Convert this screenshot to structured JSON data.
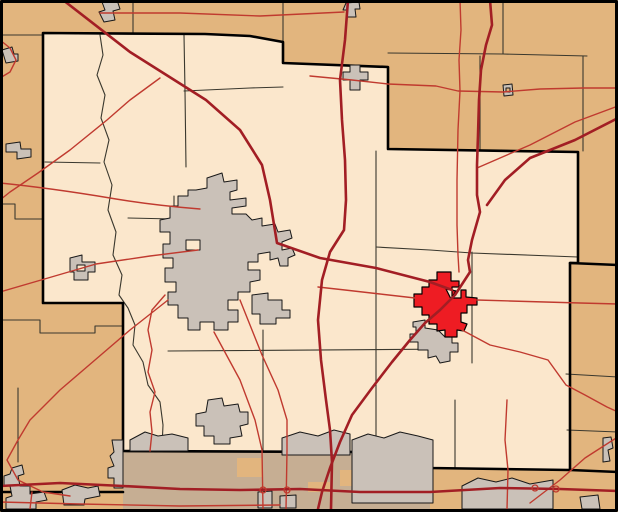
{
  "map": {
    "title": "county-municipality-locator-map",
    "canvas": {
      "width": 618,
      "height": 512
    },
    "colors": {
      "adjacent_county": "#e2b57e",
      "focal_county": "#fbe7cc",
      "municipality_gray": "#cac1b8",
      "urbanized_overlay": "#c6ae93",
      "highlight_red": "#ee1c23",
      "road_major": "#a21e24",
      "road_minor": "#c03a2f",
      "boundary_county": "#000000",
      "boundary_township": "#3a382e",
      "outline_municipality": "#181818",
      "frame": "#000000"
    },
    "layers": [
      {
        "name": "base",
        "kind": "rect",
        "items": [
          {
            "id": "surrounding-counties-fill",
            "x": 0,
            "y": 0,
            "w": 618,
            "h": 512,
            "fill": "adjacent_county"
          }
        ]
      },
      {
        "name": "county-fills",
        "kind": "path",
        "items": [
          {
            "id": "focal-county-fill",
            "fill": "focal_county",
            "d": "M43,33 L205,34 L250,36 L283,42 L283,63 L388,67 L388,149 L578,152 L578,263 L570,263 L570,470 L430,468 L430,454 L360,452 L123,451 L123,303 L43,303 Z"
          }
        ]
      },
      {
        "name": "urbanized-areas",
        "kind": "path",
        "items": [
          {
            "id": "urbanized-strip-south",
            "fill": "urbanized_overlay",
            "d": "M123,451 L360,452 L364,467 L430,468 L430,509 L123,509 Z"
          },
          {
            "id": "strip-tan-pocket-1",
            "fill": "adjacent_county",
            "d": "M237,458 L262,458 L262,477 L237,477 Z"
          },
          {
            "id": "strip-tan-pocket-2",
            "fill": "adjacent_county",
            "d": "M340,470 L362,470 L362,486 L340,486 Z"
          },
          {
            "id": "strip-tan-pocket-3",
            "fill": "adjacent_county",
            "d": "M308,482 L330,482 L330,492 L308,492 Z"
          }
        ]
      },
      {
        "name": "township-lines",
        "kind": "path",
        "stroke": "boundary_township",
        "width": 1.1,
        "items": [
          {
            "id": "township-line-1",
            "d": "M0,35 L43,35"
          },
          {
            "id": "township-line-2",
            "d": "M0,204 L15,204 L15,219 L43,219"
          },
          {
            "id": "township-line-3",
            "d": "M0,320 L40,320 L40,333 L95,333 L95,326 L123,326"
          },
          {
            "id": "township-line-4",
            "d": "M18,388 L18,462"
          },
          {
            "id": "township-line-5",
            "d": "M133,0 L133,33"
          },
          {
            "id": "township-line-6",
            "d": "M283,0 L283,42"
          },
          {
            "id": "township-line-7",
            "d": "M388,53 L503,54 L587,56"
          },
          {
            "id": "township-line-8",
            "d": "M503,0 L503,54"
          },
          {
            "id": "township-line-9",
            "d": "M480,56 L480,150"
          },
          {
            "id": "township-line-10",
            "d": "M583,56 L583,151"
          },
          {
            "id": "township-line-11",
            "d": "M566,374 L618,377"
          },
          {
            "id": "township-line-12",
            "d": "M567,430 L618,432"
          },
          {
            "id": "stream-line",
            "d": "M100,35 L103,55 L97,75 L105,95 L101,118 L109,140 L104,162 L112,185 L108,210 L116,232 L113,255 L122,275 L119,295 L128,308 L135,325 L133,345 L143,362 L148,385 L160,402 L163,425 L162,447"
          },
          {
            "id": "township-line-13",
            "d": "M45,162 L100,163"
          },
          {
            "id": "township-line-14",
            "d": "M128,218 L174,219"
          },
          {
            "id": "township-line-15",
            "d": "M174,196 L174,219"
          },
          {
            "id": "township-line-16",
            "d": "M184,35 L185,91 L186,167"
          },
          {
            "id": "township-line-17",
            "d": "M184,91 L250,88 L283,87"
          },
          {
            "id": "township-line-18",
            "d": "M168,351 L456,349"
          },
          {
            "id": "township-line-19",
            "d": "M263,330 L263,452"
          },
          {
            "id": "township-line-20",
            "d": "M376,151 L376,452"
          },
          {
            "id": "township-line-21",
            "d": "M455,400 L455,468"
          },
          {
            "id": "township-line-22",
            "d": "M472,252 L472,363"
          },
          {
            "id": "township-line-23",
            "d": "M376,247 L430,250 L472,253 L578,257"
          }
        ]
      },
      {
        "name": "county-boundaries",
        "kind": "path",
        "stroke": "boundary_county",
        "width": 2.6,
        "items": [
          {
            "id": "focal-county-boundary",
            "d": "M43,33 L205,34 L250,36 L283,42 L283,63 L388,67 L388,149 L578,152 L578,263 L570,263 L570,470 L430,468 L430,454 L360,452 L123,451 L123,303 L43,303 Z"
          },
          {
            "id": "county-boundary-southwest",
            "d": "M0,492 L123,492"
          },
          {
            "id": "county-boundary-southeast",
            "d": "M570,470 L618,472"
          },
          {
            "id": "county-boundary-east-step",
            "d": "M570,263 L618,265"
          }
        ]
      },
      {
        "name": "municipalities",
        "kind": "path",
        "fill": "municipality_gray",
        "stroke": "outline_municipality",
        "width": 1,
        "items": [
          {
            "id": "city-main",
            "d": "M196,190 L207,188 L207,178 L222,173 L224,182 L237,180 L237,190 L230,192 L230,200 L246,198 L246,206 L232,208 L232,214 L246,214 L252,220 L262,218 L262,226 L275,224 L278,232 L290,230 L292,238 L282,242 L282,250 L292,248 L295,255 L288,258 L288,266 L280,266 L278,258 L270,260 L270,252 L258,254 L258,262 L248,262 L248,270 L260,270 L260,280 L250,282 L250,292 L238,292 L238,300 L228,300 L228,310 L238,310 L238,322 L228,322 L228,330 L214,330 L214,322 L200,322 L200,330 L188,330 L188,318 L178,318 L178,305 L168,305 L168,292 L176,292 L176,282 L165,282 L165,268 L173,268 L173,258 L163,258 L163,244 L170,244 L170,232 L160,232 L160,220 L170,218 L170,206 L178,206 L178,196 L188,196 L188,190 Z M186,240 L200,240 L200,250 L186,250 Z"
          },
          {
            "id": "town-satellite-south",
            "d": "M252,295 L268,293 L268,300 L282,300 L282,310 L290,310 L290,318 L276,318 L276,324 L260,324 L260,314 L252,314 Z"
          },
          {
            "id": "town-west-small",
            "d": "M70,258 L82,255 L82,262 L95,262 L95,272 L88,272 L88,280 L74,280 L74,272 L70,272 Z M77,265 L85,265 L85,271 L77,271 Z"
          },
          {
            "id": "town-nw-1",
            "d": "M6,144 L20,142 L21,149 L31,149 L31,157 L17,159 L17,152 L6,152 Z"
          },
          {
            "id": "town-nw-2",
            "d": "M2,50 L12,47 L14,54 L18,54 L18,61 L6,63 Z"
          },
          {
            "id": "town-top-strip",
            "d": "M102,2 L117,0 L120,9 L113,11 L115,20 L104,22 L99,12 L105,10 Z"
          },
          {
            "id": "town-top-center",
            "d": "M346,3 L359,2 L360,9 L355,9 L356,17 L347,17 L347,10 L343,10 Z"
          },
          {
            "id": "town-cross-north",
            "d": "M350,65 L360,65 L360,72 L368,72 L368,80 L360,80 L360,90 L350,90 L350,80 L343,80 L343,72 L350,72 Z"
          },
          {
            "id": "town-ne-tiny",
            "d": "M503,85 L512,84 L513,95 L504,96 Z M506,88 L510,88 L510,92 L506,92 Z"
          },
          {
            "id": "town-below-highlight",
            "d": "M413,322 L425,320 L425,328 L438,330 L445,337 L452,335 L452,343 L458,343 L458,352 L450,352 L450,361 L440,363 L436,356 L428,358 L428,350 L418,350 L418,342 L410,342 L410,334 L416,334 L416,327 L413,327 Z"
          },
          {
            "id": "town-bottom-big",
            "d": "M208,400 L222,398 L224,406 L238,404 L240,412 L248,412 L248,424 L240,426 L242,436 L230,438 L230,444 L214,444 L214,436 L204,436 L204,426 L196,426 L196,414 L206,412 Z"
          },
          {
            "id": "urban-band-1",
            "d": "M130,440 L145,432 L158,436 L172,434 L188,438 L188,451 L130,451 Z"
          },
          {
            "id": "urban-band-2",
            "d": "M282,438 L300,432 L318,436 L334,430 L350,434 L350,455 L282,455 Z"
          },
          {
            "id": "urban-strip-east",
            "d": "M352,440 L368,434 L384,438 L400,432 L418,436 L433,440 L433,503 L352,503 Z"
          },
          {
            "id": "urban-strip-se",
            "d": "M462,486 L478,478 L496,482 L512,478 L530,484 L553,480 L553,509 L462,509 Z"
          },
          {
            "id": "town-right-edge",
            "d": "M603,438 L611,437 L613,448 L608,450 L610,461 L603,462 Z"
          },
          {
            "id": "town-bottom-left",
            "d": "M12,468 L22,465 L24,474 L18,476 L20,486 L30,486 L30,494 L44,492 L47,500 L36,502 L36,509 L6,509 L6,498 L12,496 L10,486 L4,486 L4,476 L10,474 Z"
          },
          {
            "id": "town-corridor",
            "d": "M112,440 L123,440 L123,488 L114,488 L114,478 L108,478 L108,468 L114,466 L110,456 L114,452 Z"
          },
          {
            "id": "town-bottom-small",
            "d": "M62,490 L75,485 L88,488 L98,486 L100,496 L85,499 L84,505 L64,505 Z"
          },
          {
            "id": "town-bottom-tiny-1",
            "d": "M258,492 L272,491 L272,508 L258,508 Z"
          },
          {
            "id": "town-bottom-tiny-2",
            "d": "M280,496 L296,495 L296,508 L280,508 Z"
          },
          {
            "id": "town-bottom-tiny-3",
            "d": "M580,497 L598,495 L600,509 L582,509 Z"
          }
        ]
      },
      {
        "name": "highlight",
        "kind": "path",
        "fill": "highlight_red",
        "stroke": "boundary_county",
        "width": 1.2,
        "items": [
          {
            "id": "highlighted-municipality",
            "d": "M437,272 L451,272 L451,281 L459,281 L459,287 L452,287 L452,298 L461,298 L461,290 L466,290 L466,297 L477,298 L477,305 L467,305 L467,313 L461,313 L461,322 L467,324 L464,331 L457,330 L457,337 L445,337 L445,330 L437,331 L437,324 L429,324 L429,315 L422,315 L422,307 L414,307 L414,294 L422,294 L422,287 L429,287 L429,280 L437,280 Z M446,289 L456,291 L451,299 Z"
          }
        ]
      },
      {
        "name": "roads-minor",
        "kind": "path",
        "stroke": "road_minor",
        "width": 1.4,
        "items": [
          {
            "id": "road-minor-1",
            "d": "M0,183 C40,187 80,193 110,198 C145,204 175,207 200,209"
          },
          {
            "id": "road-minor-2",
            "d": "M0,292 L48,278 L96,264 L150,256 L198,250"
          },
          {
            "id": "road-minor-3",
            "d": "M168,300 L130,330 L95,360 L60,390 L30,420 L18,440 L7,460 L18,480 L43,492 L70,496"
          },
          {
            "id": "road-minor-4",
            "d": "M165,295 L152,310 L148,330 L152,350 L148,372 L155,392 L150,412 L152,432 L150,451"
          },
          {
            "id": "road-minor-5",
            "d": "M214,332 L240,380 L255,420 L262,450 L263,509"
          },
          {
            "id": "road-minor-6",
            "d": "M240,300 L262,355 L278,390 L287,420 L287,451 L286,509"
          },
          {
            "id": "road-minor-7",
            "d": "M310,76 L352,80 L388,84 L436,86 L458,91 L503,92 L540,89 L583,88 L618,88"
          },
          {
            "id": "road-minor-8",
            "d": "M460,0 L461,30 L459,60 L460,91 L458,130 L457,180 L457,225 L458,255 L459,272"
          },
          {
            "id": "road-minor-9",
            "d": "M415,298 L380,294 L345,290 L318,287"
          },
          {
            "id": "road-minor-10",
            "d": "M477,300 L510,301 L545,302 L580,303 L618,304"
          },
          {
            "id": "road-minor-11",
            "d": "M462,330 L490,345 L520,352 L548,360 L566,385 L585,395 L607,407 L618,412"
          },
          {
            "id": "road-minor-12",
            "d": "M530,503 L560,480 L585,458 L613,440 L618,437"
          },
          {
            "id": "road-minor-13",
            "d": "M477,168 L530,145 L575,122 L618,106"
          },
          {
            "id": "road-minor-14",
            "d": "M160,78 L130,100 L107,120 L70,150 L38,173 L10,192 L0,200"
          },
          {
            "id": "road-minor-15",
            "d": "M0,40 L10,48 L16,60 L10,72 L0,78"
          },
          {
            "id": "road-minor-16",
            "d": "M100,13 L180,13 L260,16 L344,12"
          },
          {
            "id": "road-minor-17",
            "d": "M507,400 L505,440 L508,470 L507,509"
          },
          {
            "id": "road-minor-18",
            "d": "M0,502 L80,504 L180,506 L280,505"
          },
          {
            "id": "road-minor-19",
            "d": "M32,492 L30,509"
          }
        ]
      },
      {
        "name": "roads-major",
        "kind": "path",
        "stroke": "road_major",
        "width": 2.6,
        "items": [
          {
            "id": "highway-northwest-diagonal",
            "d": "M63,0 L130,52 L206,100 L240,130 L262,165 L270,200 L277,243 L320,258 L376,268 L430,282 L452,290"
          },
          {
            "id": "highway-north-south-center",
            "d": "M348,0 L345,40 L340,80 L342,120 L345,160 L346,200 L344,230 L330,252 L322,280 L318,320 L321,360 L326,400 L330,430 L332,462 L331,509"
          },
          {
            "id": "highway-through-highlight",
            "d": "M490,0 L492,25 L486,45 L481,70 L479,100 L478,135 L477,165 L477,195 L480,212 L472,240 L468,260 L470,272 L455,295 L440,310 L425,323 L410,340 L392,362 L372,388 L352,415 L340,442 L330,468 L322,492 L318,509"
          },
          {
            "id": "highway-northeast-diagonal",
            "d": "M618,118 L575,140 L530,158 L505,180 L487,205"
          },
          {
            "id": "highway-south-eastwest",
            "d": "M0,486 L60,483 L123,486 L180,489 L240,490 L300,489 L360,492 L430,492 L500,488 L560,489 L618,491"
          }
        ]
      },
      {
        "name": "interchanges",
        "kind": "circle",
        "stroke": "road_minor",
        "width": 1.3,
        "items": [
          {
            "id": "interchange-ring-1",
            "cx": 263,
            "cy": 490,
            "r": 3
          },
          {
            "id": "interchange-ring-2",
            "cx": 287,
            "cy": 490,
            "r": 3
          },
          {
            "id": "interchange-ring-3",
            "cx": 535,
            "cy": 488,
            "r": 3
          },
          {
            "id": "interchange-ring-4",
            "cx": 556,
            "cy": 489,
            "r": 3
          }
        ]
      },
      {
        "name": "frame",
        "kind": "rect",
        "items": [
          {
            "id": "map-image-border",
            "x": 1.5,
            "y": 1.5,
            "w": 615,
            "h": 509,
            "fill": "none",
            "stroke": "frame",
            "width": 3
          }
        ]
      }
    ]
  }
}
